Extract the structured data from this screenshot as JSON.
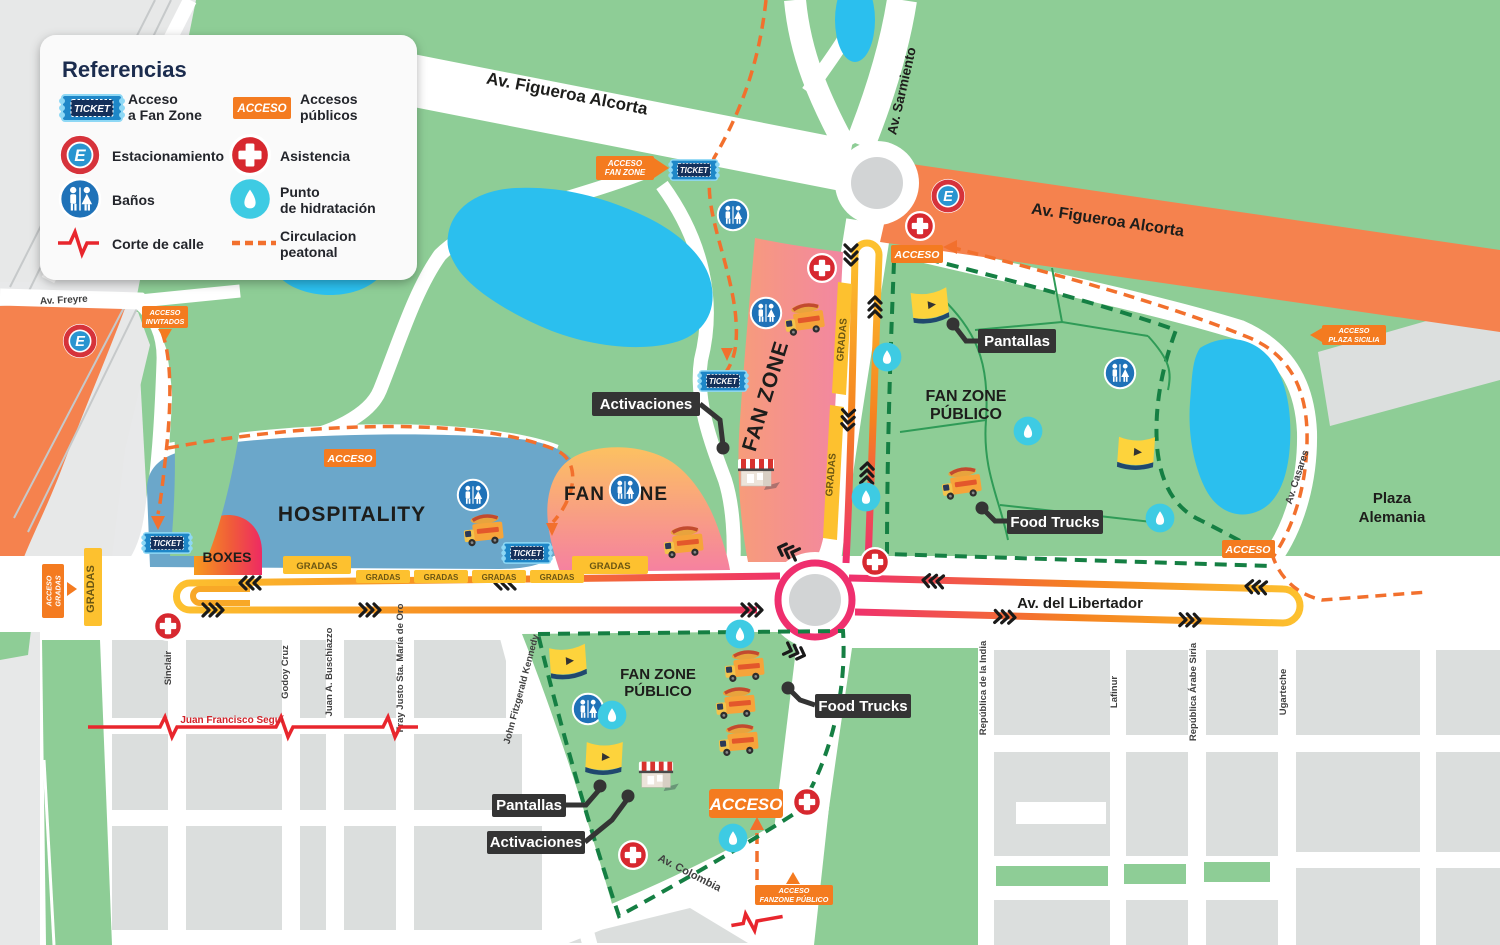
{
  "legend": {
    "title": "Referencias",
    "items": {
      "fanzone_access": {
        "line1": "Acceso",
        "line2": "a Fan Zone"
      },
      "public_access": {
        "line1": "Accesos",
        "line2": "públicos"
      },
      "parking": "Estacionamiento",
      "assistance": "Asistencia",
      "restrooms": "Baños",
      "hydration": {
        "line1": "Punto",
        "line2": "de hid​ratación"
      },
      "road_closure": "Corte de calle",
      "pedestrian": {
        "line1": "Circulacion",
        "line2": "peatonal"
      }
    }
  },
  "badges": {
    "ticket": "TICKET",
    "acceso": "ACCESO",
    "parking_letter": "E",
    "gradas": "GRADAS",
    "acceso_fan_zone": {
      "line1": "ACCESO",
      "line2": "FAN ZONE"
    },
    "acceso_invitados": {
      "line1": "ACCESO",
      "line2": "INVITADOS"
    },
    "acceso_plaza_sicilia": {
      "line1": "ACCESO",
      "line2": "PLAZA SICILIA"
    },
    "acceso_gradas": {
      "line1": "ACCESO",
      "line2": "GRADAS"
    },
    "acceso_fanzone_publico": {
      "line1": "ACCESO",
      "line2": "FANZONE PÚBLICO"
    }
  },
  "zones": {
    "hospitality": "HOSPITALITY",
    "boxes": "BOXES",
    "fan_zone": "FAN ZONE",
    "fan_zone_publico": {
      "line1": "FAN ZONE",
      "line2": "PÚBLICO"
    },
    "plaza_alemania": {
      "line1": "Plaza",
      "line2": "Alemania"
    }
  },
  "callouts": {
    "pantallas": "Pantallas",
    "activaciones": "Activaciones",
    "food_trucks": "Food Trucks"
  },
  "streets": {
    "figueroa_alcorta": "Av. Figueroa Alcorta",
    "sarmiento": "Av. Sarmiento",
    "libertador": "Av. del Libertador",
    "freyre": "Av. Freyre",
    "casares": "Av. Casares",
    "colombia": "Av. Colombia",
    "sinclair": "Sinclair",
    "godoy_cruz": "Godoy Cruz",
    "buschiazzo": "Juan A. Buschiazzo",
    "fray_justo": "Fray Justo Sta. María de Oro",
    "segui": "Juan Francisco Seguí",
    "kennedy": "John Fitzgerald Kennedy",
    "india": "República de la India",
    "lafinur": "Lafinur",
    "arabe_siria": "República Árabe Siria",
    "ugarteche": "Ugarteche"
  },
  "colors": {
    "park_green": "#8ecd96",
    "lake_blue": "#2bbfee",
    "closed_road_orange": "#f5824e",
    "track_pink": "#ef2f6e",
    "track_orange": "#f58220",
    "track_yellow": "#fdc12f",
    "pedestrian_dash_orange": "#f2702d",
    "boundary_dash_green": "#157f43",
    "hospitality_blue": "#6ba7ca",
    "badge_orange": "#f47b20",
    "ticket_blue": "#1e87c8",
    "assistance_red": "#d7282f",
    "banos_blue": "#1f72b8",
    "hydration_cyan": "#3ecbe3"
  }
}
